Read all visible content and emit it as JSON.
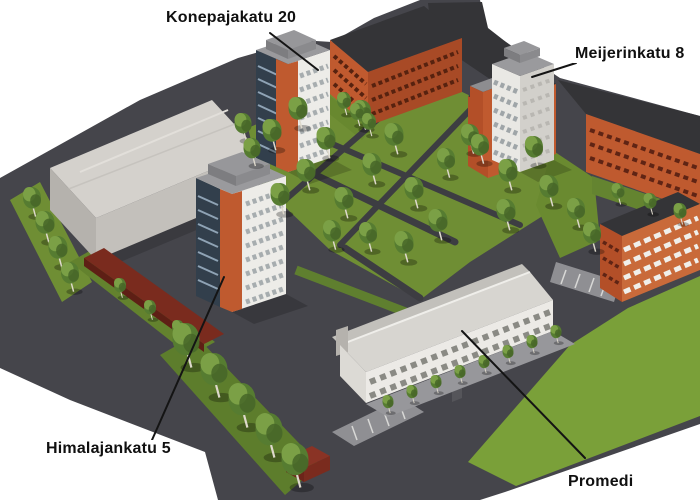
{
  "annotations": [
    {
      "id": "konepajakatu-20",
      "label": "Konepajakatu 20"
    },
    {
      "id": "meijerinkatu-8",
      "label": "Meijerinkatu 8"
    },
    {
      "id": "himalajankatu-5",
      "label": "Himalajankatu 5"
    },
    {
      "id": "promedi",
      "label": "Promedi"
    }
  ],
  "colors": {
    "background": "#ffffff",
    "asphalt": "#45454b",
    "path": "#3d3d42",
    "lawn": "#6f8e34",
    "lawn_bright": "#7aa039",
    "tree_dark": "#567c31",
    "tree_light": "#7ba046",
    "brick_orange": "#bf5a2f",
    "brick_shaded": "#a84a26",
    "brick_dark_red": "#7a2b1e",
    "roof_dark": "#343437",
    "facade_white": "#edece8",
    "facade_gray": "#d2d0cb",
    "warehouse_gray": "#d4d1cc",
    "glass_blue": "#323f4c",
    "leader_line": "#141414",
    "label_text": "#101010"
  }
}
